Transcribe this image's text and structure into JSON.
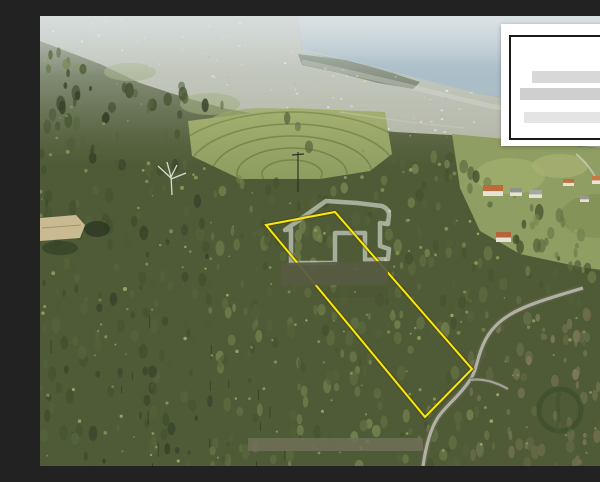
{
  "scene": {
    "description": "Aerial drone photograph of a forested hillside plot above a coastal hillside town and the sea; a land parcel is outlined in yellow, with a translucent house-logo watermark and blurred redaction bars over the photo, and a white agency logo card with placeholder text bars in the top-right corner",
    "palette": {
      "sea": "#8aa5b4",
      "haze": "#dee5e7",
      "forest": "#4f5b36",
      "fields": "#9cab6c",
      "road": "#b4b5a6"
    }
  },
  "parcel_outline": {
    "color": "#f9e712",
    "halo_color": "rgba(70,62,0,0.45)",
    "points": [
      [
        226,
        209
      ],
      [
        295,
        196
      ],
      [
        432,
        353
      ],
      [
        385,
        401
      ]
    ]
  },
  "watermark": {
    "house_logo": {
      "color": "rgba(238,240,238,0.55)",
      "stroke_width": 4.5
    },
    "redaction_bars": [
      {
        "x": 241,
        "y": 246,
        "w": 107,
        "h": 23,
        "color": "#565a42",
        "opacity": 0.93,
        "rotate": -1
      },
      {
        "x": 286,
        "y": 271,
        "w": 62,
        "h": 10,
        "color": "#4a4f34",
        "opacity": 0.38,
        "rotate": -1
      },
      {
        "x": 208,
        "y": 422,
        "w": 175,
        "h": 13,
        "color": "#6e7056",
        "opacity": 0.88,
        "rotate": 0
      }
    ],
    "faint_ring": {
      "cx": 520,
      "cy": 394,
      "r": 21,
      "color": "rgba(25,60,30,0.28)"
    }
  },
  "logo_card": {
    "background": "#ffffff",
    "border_color": "#1a1a1a",
    "bars": [
      {
        "width": 70,
        "height": 12,
        "color": "#d8d8d8",
        "margin_top": 34
      },
      {
        "width": 93,
        "height": 12,
        "color": "#cfcfcf",
        "margin_top": 5
      },
      {
        "width": 85,
        "height": 11,
        "color": "#e4e4e4",
        "margin_top": 12
      }
    ]
  }
}
